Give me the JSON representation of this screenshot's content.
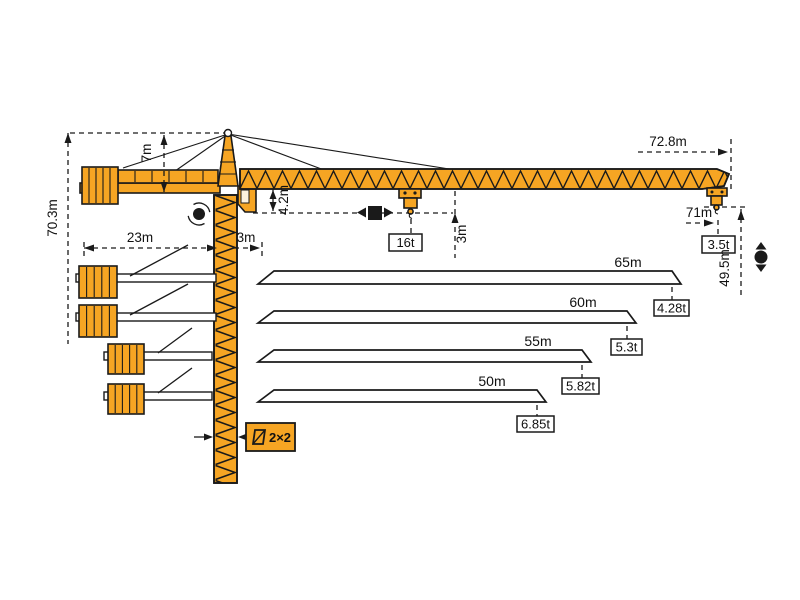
{
  "diagram": {
    "type": "tower-crane-load-diagram",
    "colors": {
      "crane_orange": "#F6A523",
      "outline": "#1A1A1A",
      "background": "#FFFFFF"
    },
    "dimensions": {
      "total_height": "70.3m",
      "apex_above_jib": "7m",
      "counterjib_length": "23m",
      "rear_offset": "3m",
      "jib_root_height": "4.2m",
      "hook_clearance": "3m",
      "jib_overall_length": "72.8m",
      "max_working_radius": "71m",
      "hook_height_at_tip": "49.5m",
      "mast_cross_section": "2×2"
    },
    "loads": {
      "max_capacity": "16t",
      "tip_capacity": "3.5t"
    },
    "load_chart": {
      "rows": [
        {
          "jib_length": "65m",
          "tip_capacity": "4.28t"
        },
        {
          "jib_length": "60m",
          "tip_capacity": "5.3t"
        },
        {
          "jib_length": "55m",
          "tip_capacity": "5.82t"
        },
        {
          "jib_length": "50m",
          "tip_capacity": "6.85t"
        }
      ]
    },
    "icons": {
      "slewing": "slewing-icon",
      "trolley_travel": "trolley-travel-icon",
      "hoisting": "hoisting-icon",
      "mast_section": "mast-section-icon"
    }
  }
}
